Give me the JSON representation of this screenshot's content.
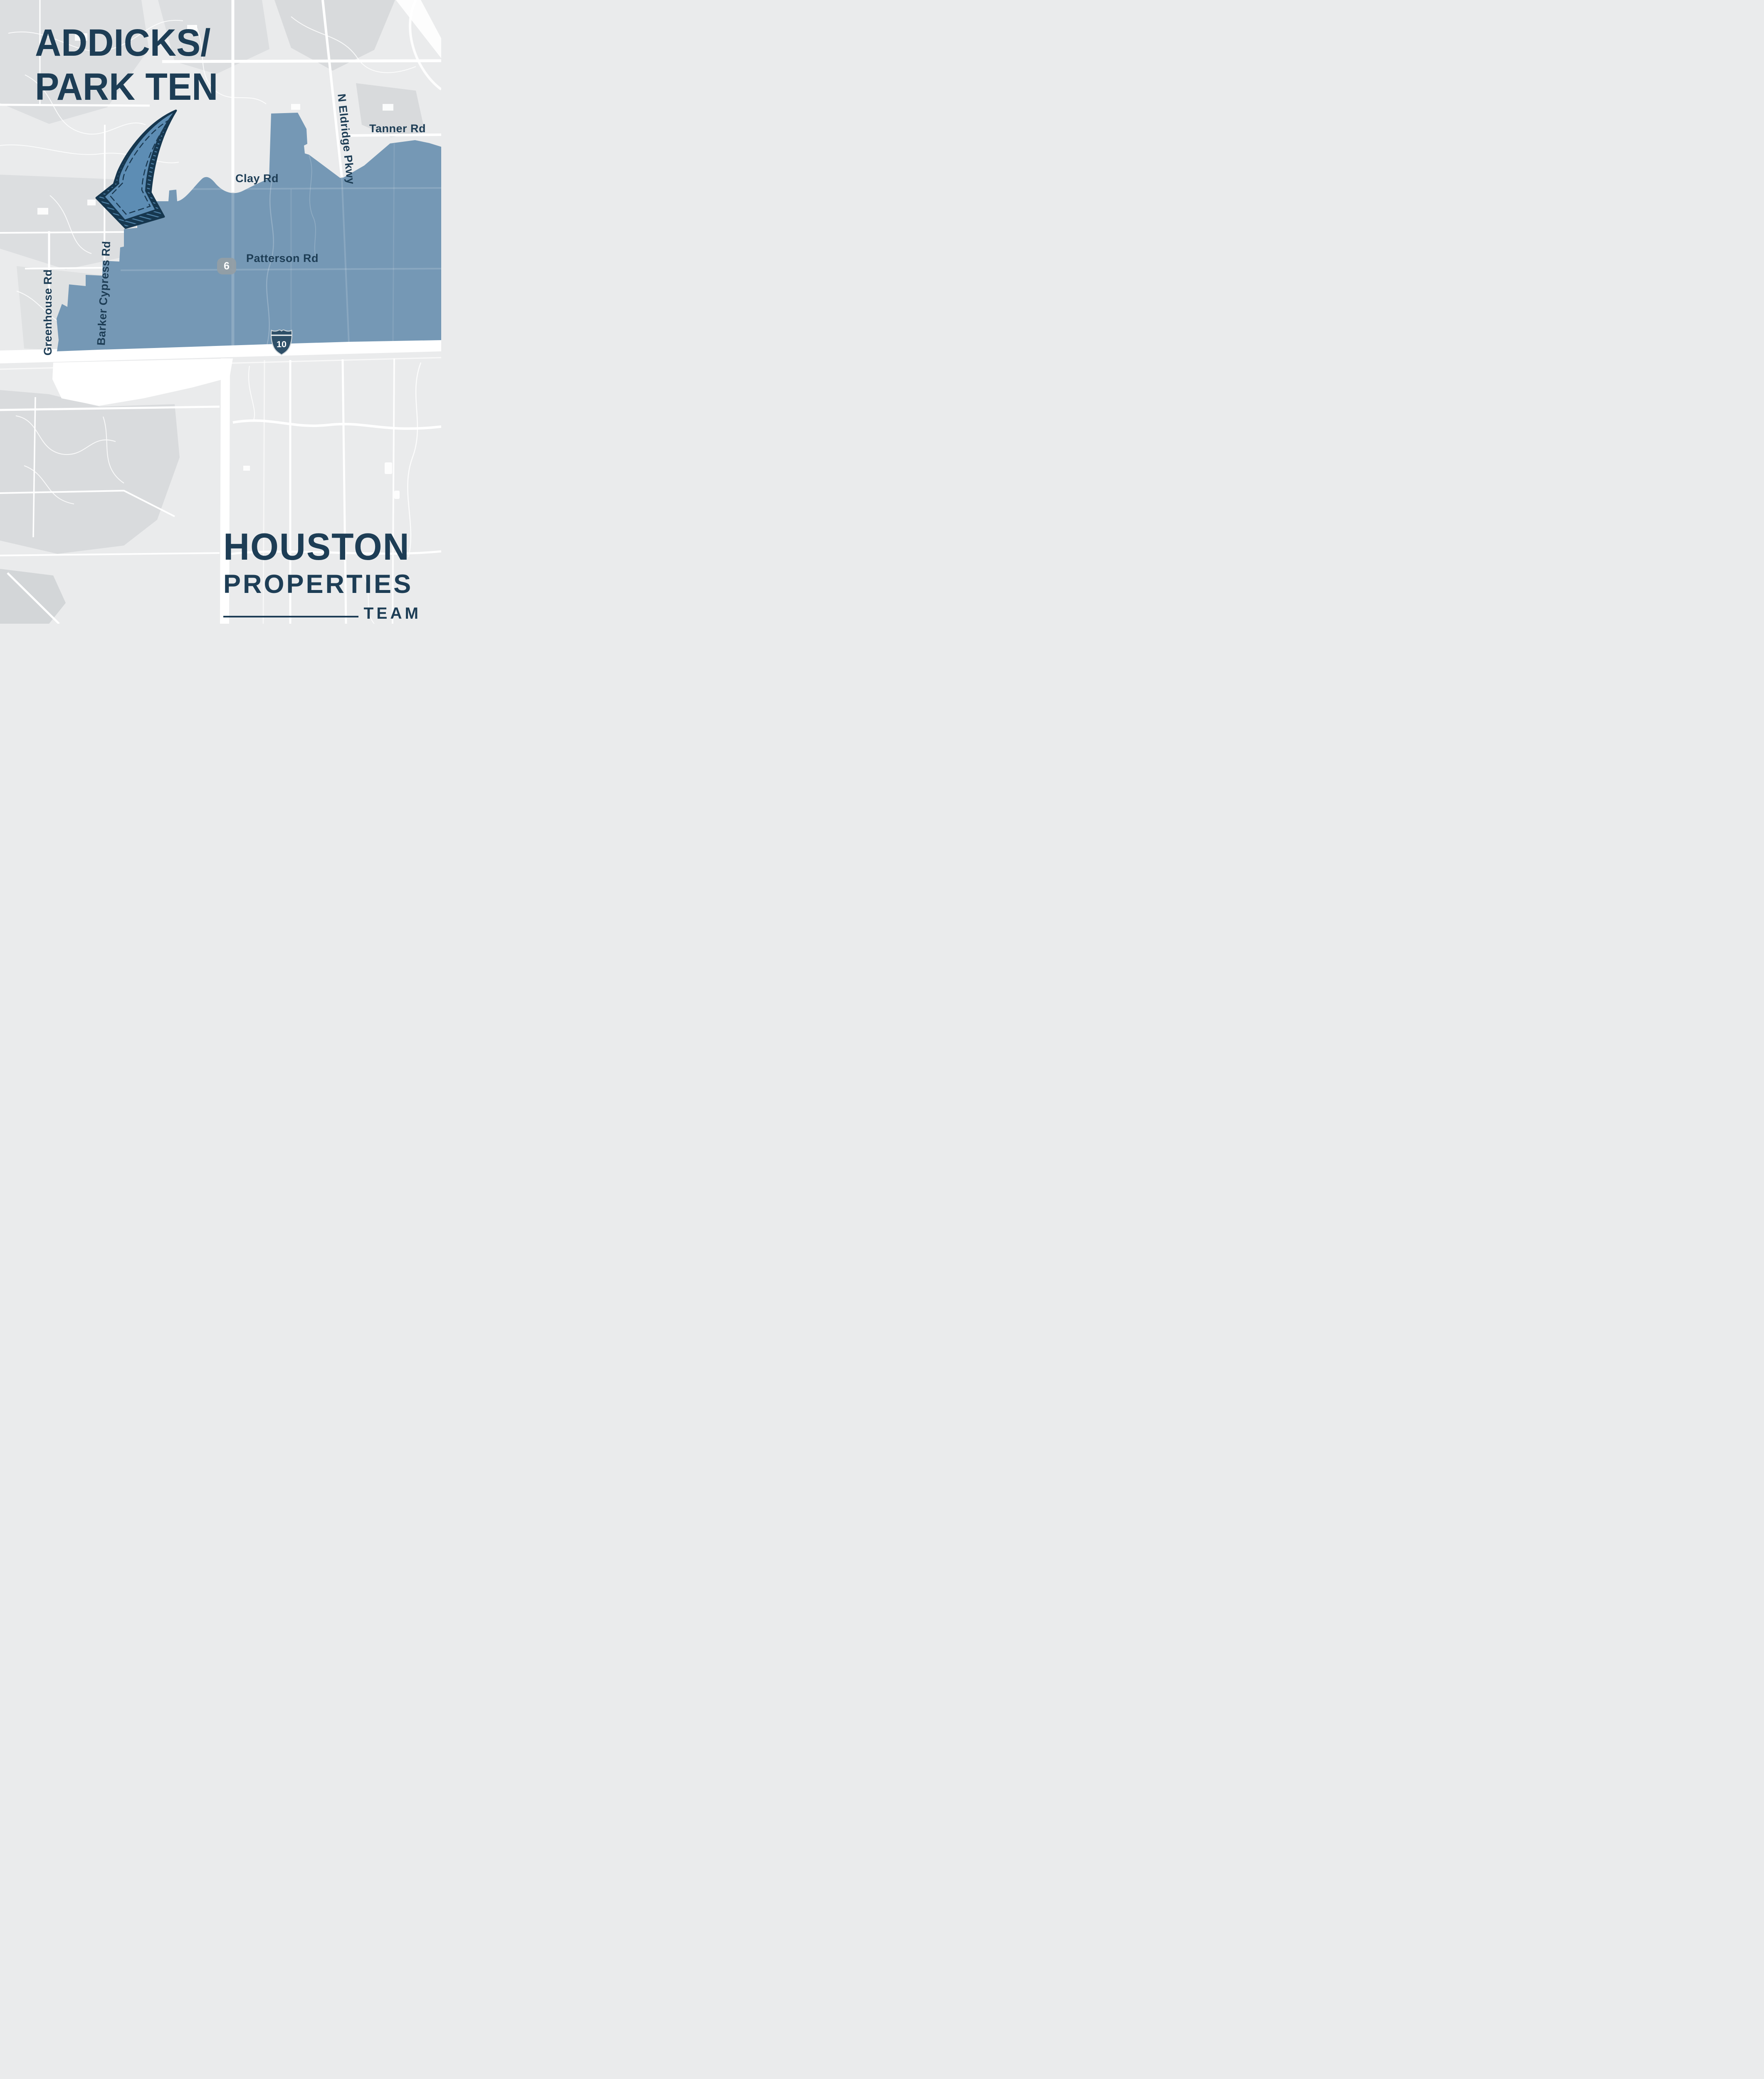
{
  "title": {
    "line1": "ADDICKS/",
    "line2": "PARK TEN"
  },
  "map": {
    "road_labels": [
      {
        "name": "tanner-rd",
        "text": "Tanner Rd"
      },
      {
        "name": "clay-rd",
        "text": "Clay Rd"
      },
      {
        "name": "patterson-rd",
        "text": "Patterson Rd"
      },
      {
        "name": "n-eldridge-pkwy",
        "text": "N Eldridge Pkwy"
      },
      {
        "name": "barker-cypress-rd",
        "text": "Barker Cypress Rd"
      },
      {
        "name": "greenhouse-rd",
        "text": "Greenhouse Rd"
      }
    ],
    "shields": [
      {
        "name": "state-highway-6",
        "number": "6"
      },
      {
        "name": "interstate-10",
        "number": "10"
      }
    ]
  },
  "logo": {
    "line1": "HOUSTON",
    "line2": "PROPERTIES",
    "line3": "TEAM"
  },
  "colors": {
    "navy": "#1d3d55",
    "region_blue": "#7598b5",
    "arrow_blue": "#5d8db4",
    "shield_gray": "#949ea5",
    "interstate_navy": "#2e4f68",
    "map_base": "#eaebec",
    "map_patch": "#dcdee0",
    "road_white": "#ffffff"
  }
}
